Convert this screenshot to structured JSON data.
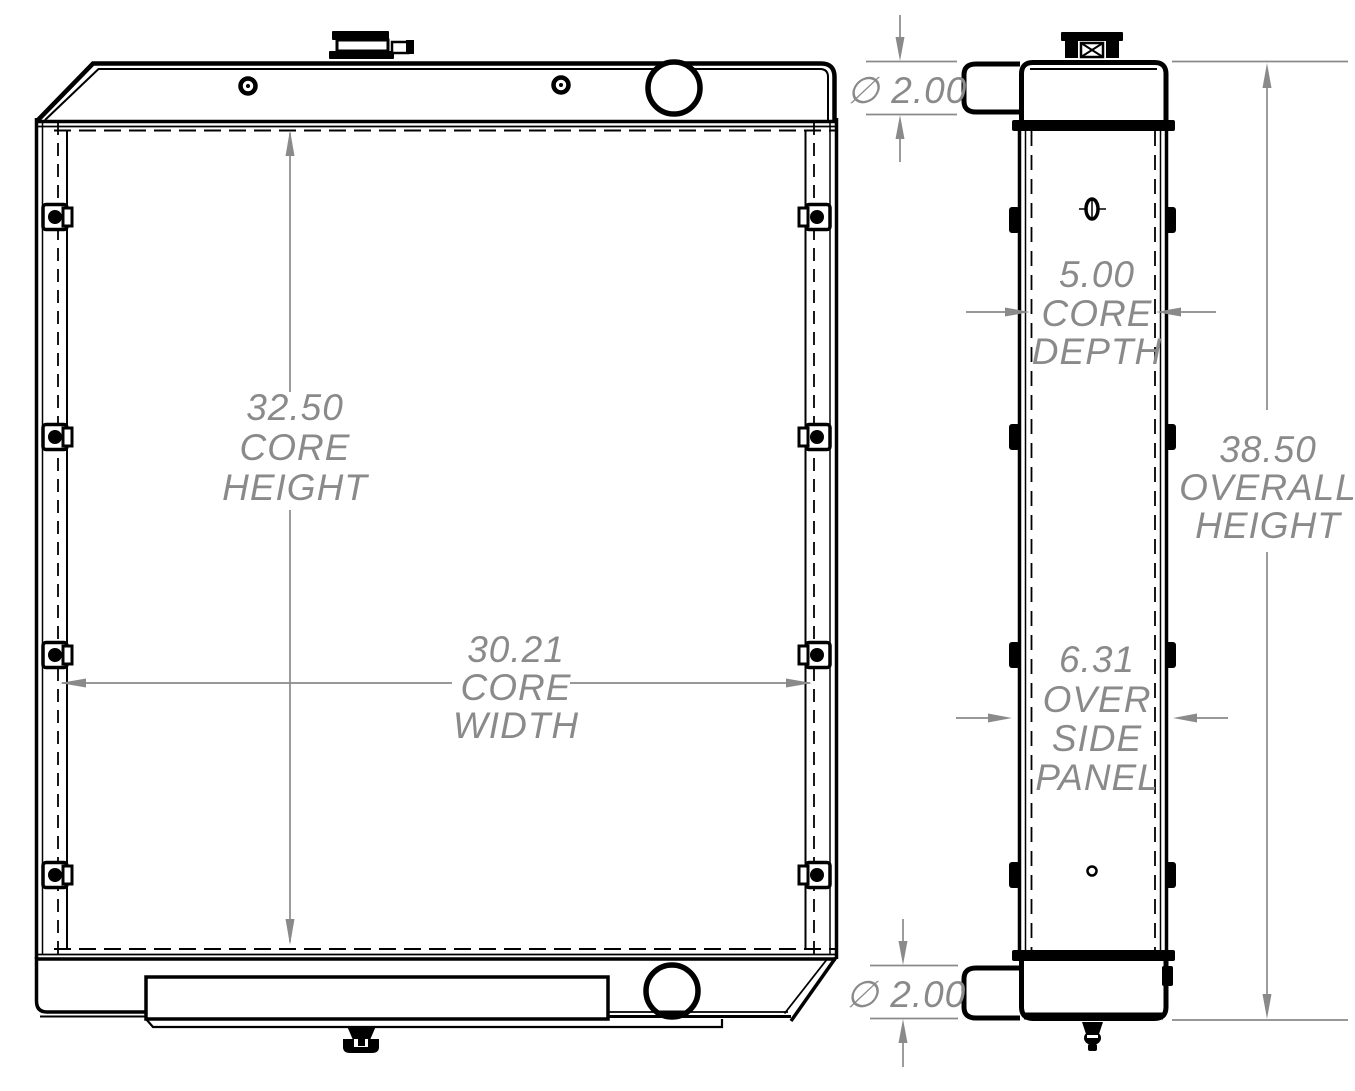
{
  "colors": {
    "drawing_line": "#000000",
    "dimension": "#8a8a8a",
    "background": "#ffffff"
  },
  "dimensions": {
    "top_port_diameter": {
      "label": "∅ 2.00"
    },
    "core_height": {
      "lines": [
        "32.50",
        "CORE",
        "HEIGHT"
      ]
    },
    "core_width": {
      "lines": [
        "30.21",
        "CORE",
        "WIDTH"
      ]
    },
    "core_depth": {
      "lines": [
        "5.00",
        "CORE",
        "DEPTH"
      ]
    },
    "overall_height": {
      "lines": [
        "38.50",
        "OVERALL",
        "HEIGHT"
      ]
    },
    "over_side_panel": {
      "lines": [
        "6.31",
        "OVER",
        "SIDE",
        "PANEL"
      ]
    },
    "bottom_port_diameter": {
      "label": "∅ 2.00"
    }
  }
}
